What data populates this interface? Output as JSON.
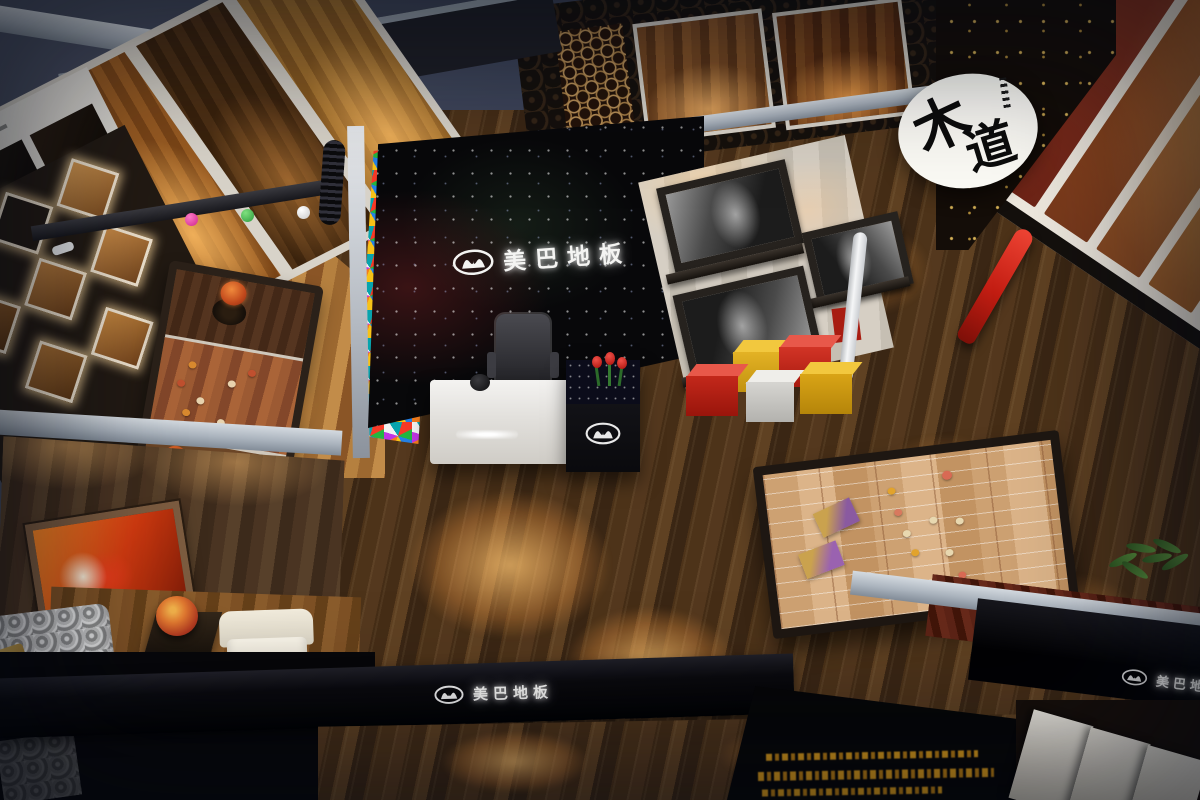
{
  "scene": {
    "brand": {
      "logo_text": "美巴地板",
      "round_sign_char_1": "木",
      "round_sign_char_2": "道"
    },
    "palette": {
      "background_navy": "#2a3060",
      "background_slate": "#3d4459",
      "wall_cap_gray": "#aab3bd",
      "feature_wall_black": "#08080a",
      "walnut_floor": "#4a3018",
      "oak_floor": "#9c6a33",
      "platform_maple": "#d6a77b",
      "stool_red": "#c3281b",
      "stool_yellow": "#d9a416",
      "vase_red": "#d62c20",
      "gold_text": "#d69a1e",
      "sign_white": "#fbfaf5"
    }
  }
}
